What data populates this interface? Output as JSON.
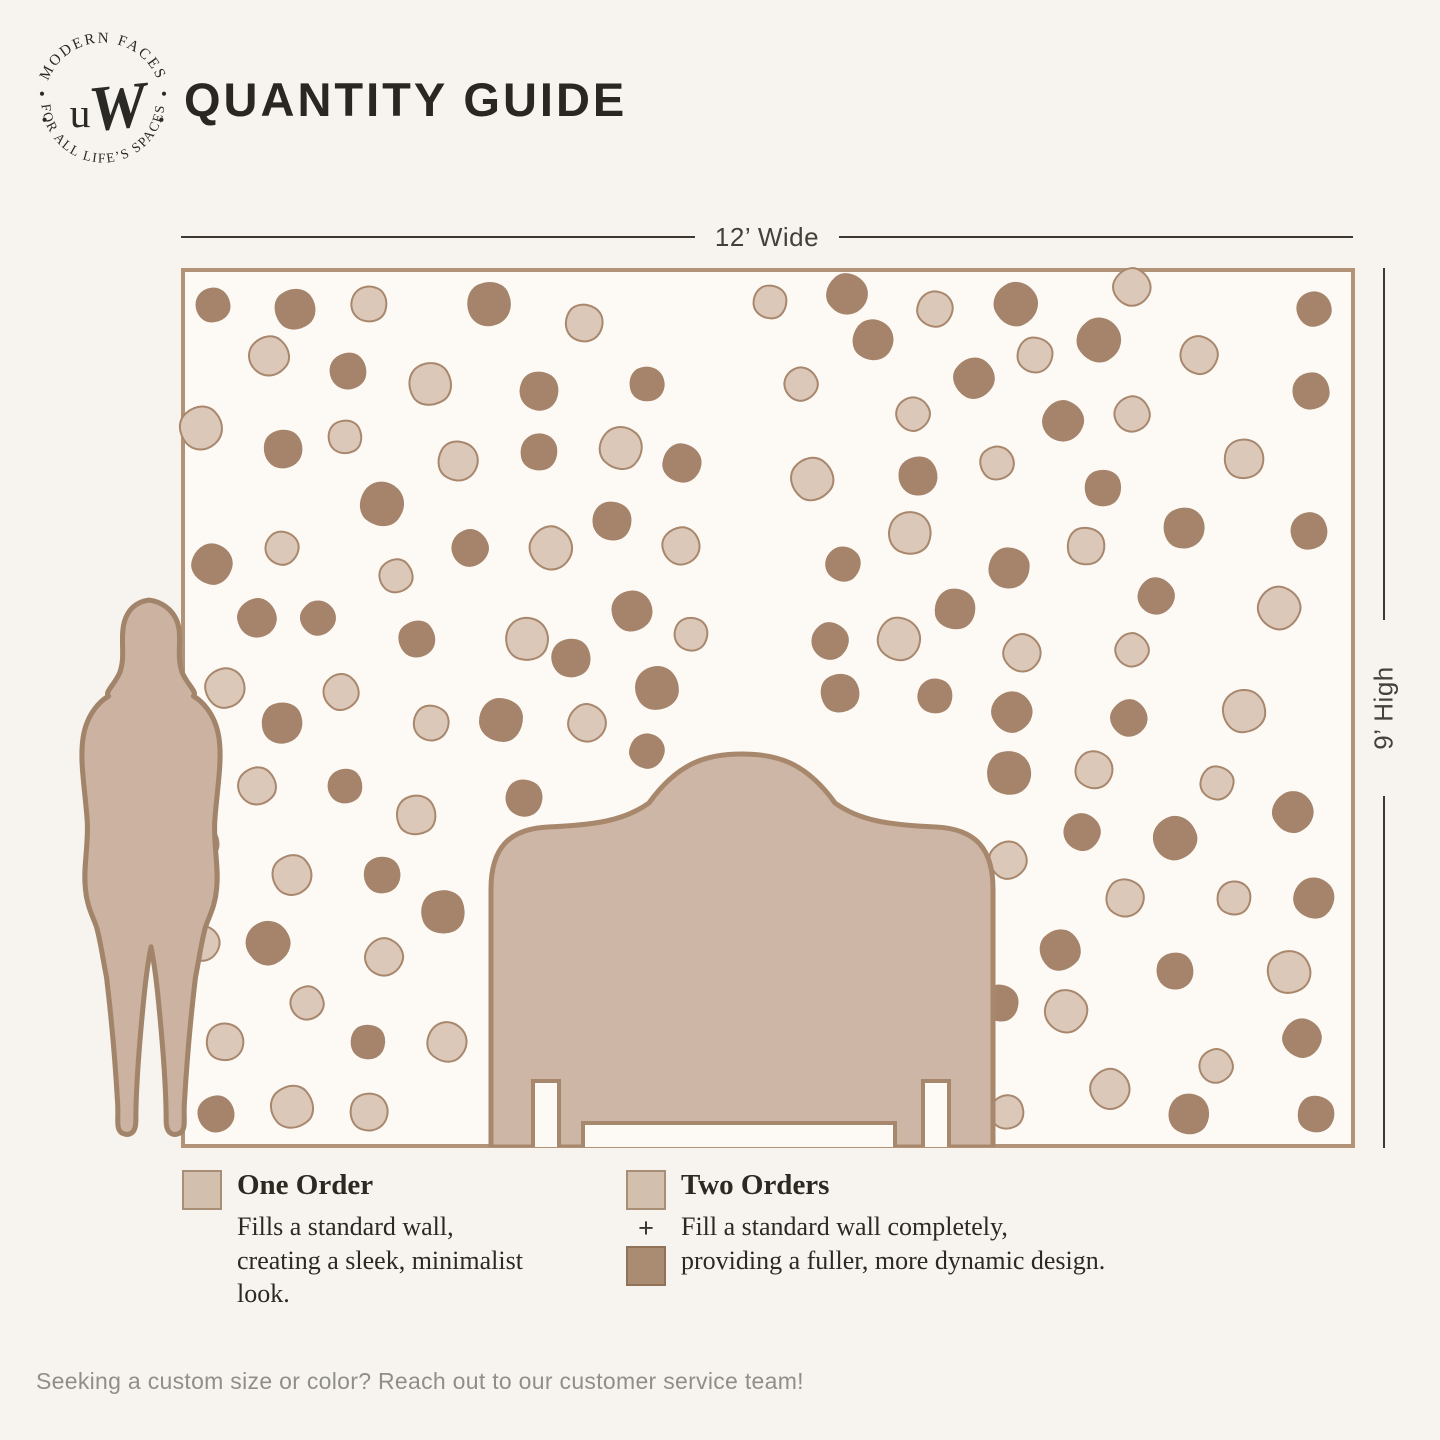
{
  "brand": {
    "logo_top_text": "MODERN FACES",
    "logo_bottom_text": "FOR ALL LIFE’S SPACES",
    "monogram_u": "u",
    "monogram_w": "W"
  },
  "header": {
    "title": "QUANTITY GUIDE"
  },
  "diagram": {
    "width_label": "12’ Wide",
    "height_label": "9’ High",
    "colors": {
      "page_background": "#f7f4ef",
      "wall_background": "#fdfaf5",
      "wall_border": "#b29377",
      "dot_dark": "#a5846b",
      "dot_light_fill": "#dcc8b9",
      "dot_light_outline": "#a8876d",
      "silhouette_fill": "#cbb2a1",
      "silhouette_outline": "#a1846a",
      "headboard_fill": "#cdb6a6",
      "headboard_outline": "#a8886d"
    },
    "dots": [
      {
        "x": 2.4,
        "y": 3.8,
        "c": "dark"
      },
      {
        "x": 9.4,
        "y": 4.2,
        "c": "dark"
      },
      {
        "x": 15.8,
        "y": 3.7,
        "c": "light"
      },
      {
        "x": 26.1,
        "y": 3.7,
        "c": "dark"
      },
      {
        "x": 34.2,
        "y": 5.9,
        "c": "light"
      },
      {
        "x": 50.2,
        "y": 3.4,
        "c": "light"
      },
      {
        "x": 56.8,
        "y": 2.5,
        "c": "dark"
      },
      {
        "x": 64.3,
        "y": 4.2,
        "c": "light"
      },
      {
        "x": 71.3,
        "y": 3.7,
        "c": "dark"
      },
      {
        "x": 81.2,
        "y": 1.7,
        "c": "light"
      },
      {
        "x": 96.8,
        "y": 4.2,
        "c": "dark"
      },
      {
        "x": 7.2,
        "y": 9.6,
        "c": "light"
      },
      {
        "x": 14.0,
        "y": 11.4,
        "c": "dark"
      },
      {
        "x": 21.0,
        "y": 12.9,
        "c": "light"
      },
      {
        "x": 30.4,
        "y": 13.7,
        "c": "dark"
      },
      {
        "x": 39.6,
        "y": 12.9,
        "c": "dark"
      },
      {
        "x": 59.0,
        "y": 7.8,
        "c": "dark"
      },
      {
        "x": 72.9,
        "y": 9.5,
        "c": "light"
      },
      {
        "x": 78.4,
        "y": 7.8,
        "c": "dark"
      },
      {
        "x": 87.0,
        "y": 9.5,
        "c": "light"
      },
      {
        "x": 52.8,
        "y": 12.8,
        "c": "light"
      },
      {
        "x": 67.7,
        "y": 12.2,
        "c": "dark"
      },
      {
        "x": 96.6,
        "y": 13.7,
        "c": "dark"
      },
      {
        "x": 1.4,
        "y": 17.9,
        "c": "light"
      },
      {
        "x": 8.4,
        "y": 20.3,
        "c": "dark"
      },
      {
        "x": 13.7,
        "y": 18.9,
        "c": "light"
      },
      {
        "x": 23.4,
        "y": 21.7,
        "c": "light"
      },
      {
        "x": 30.4,
        "y": 20.6,
        "c": "dark"
      },
      {
        "x": 37.4,
        "y": 20.2,
        "c": "light"
      },
      {
        "x": 42.6,
        "y": 21.9,
        "c": "dark"
      },
      {
        "x": 62.4,
        "y": 16.3,
        "c": "light"
      },
      {
        "x": 75.3,
        "y": 17.1,
        "c": "dark"
      },
      {
        "x": 81.2,
        "y": 16.3,
        "c": "light"
      },
      {
        "x": 53.8,
        "y": 23.7,
        "c": "light"
      },
      {
        "x": 62.9,
        "y": 23.4,
        "c": "dark"
      },
      {
        "x": 69.6,
        "y": 21.9,
        "c": "light"
      },
      {
        "x": 90.8,
        "y": 21.5,
        "c": "light"
      },
      {
        "x": 78.7,
        "y": 24.8,
        "c": "dark"
      },
      {
        "x": 16.9,
        "y": 26.6,
        "c": "dark"
      },
      {
        "x": 36.6,
        "y": 28.6,
        "c": "dark"
      },
      {
        "x": 8.3,
        "y": 31.7,
        "c": "light"
      },
      {
        "x": 2.3,
        "y": 33.5,
        "c": "dark"
      },
      {
        "x": 24.4,
        "y": 31.7,
        "c": "dark"
      },
      {
        "x": 31.4,
        "y": 31.7,
        "c": "light"
      },
      {
        "x": 42.5,
        "y": 31.4,
        "c": "light"
      },
      {
        "x": 18.1,
        "y": 34.9,
        "c": "light"
      },
      {
        "x": 85.7,
        "y": 29.4,
        "c": "dark"
      },
      {
        "x": 96.4,
        "y": 29.7,
        "c": "dark"
      },
      {
        "x": 62.2,
        "y": 29.9,
        "c": "light"
      },
      {
        "x": 77.3,
        "y": 31.4,
        "c": "light"
      },
      {
        "x": 56.4,
        "y": 33.5,
        "c": "dark"
      },
      {
        "x": 70.7,
        "y": 33.9,
        "c": "dark"
      },
      {
        "x": 83.3,
        "y": 37.1,
        "c": "dark"
      },
      {
        "x": 93.8,
        "y": 38.5,
        "c": "light"
      },
      {
        "x": 6.2,
        "y": 39.7,
        "c": "dark"
      },
      {
        "x": 11.4,
        "y": 39.7,
        "c": "dark"
      },
      {
        "x": 38.3,
        "y": 38.9,
        "c": "dark"
      },
      {
        "x": 19.9,
        "y": 42.1,
        "c": "dark"
      },
      {
        "x": 29.3,
        "y": 42.1,
        "c": "light"
      },
      {
        "x": 33.1,
        "y": 44.3,
        "c": "dark"
      },
      {
        "x": 43.4,
        "y": 41.5,
        "c": "light"
      },
      {
        "x": 66.0,
        "y": 38.6,
        "c": "dark"
      },
      {
        "x": 55.3,
        "y": 42.3,
        "c": "dark"
      },
      {
        "x": 61.2,
        "y": 42.1,
        "c": "light"
      },
      {
        "x": 71.8,
        "y": 43.7,
        "c": "light"
      },
      {
        "x": 81.2,
        "y": 43.4,
        "c": "light"
      },
      {
        "x": 3.4,
        "y": 47.7,
        "c": "light"
      },
      {
        "x": 13.4,
        "y": 48.2,
        "c": "light"
      },
      {
        "x": 40.5,
        "y": 47.7,
        "c": "dark"
      },
      {
        "x": 56.2,
        "y": 48.3,
        "c": "dark"
      },
      {
        "x": 64.3,
        "y": 48.6,
        "c": "dark"
      },
      {
        "x": 8.3,
        "y": 51.7,
        "c": "dark"
      },
      {
        "x": 21.1,
        "y": 51.7,
        "c": "light"
      },
      {
        "x": 27.1,
        "y": 51.4,
        "c": "dark"
      },
      {
        "x": 34.5,
        "y": 51.7,
        "c": "light"
      },
      {
        "x": 39.6,
        "y": 54.9,
        "c": "dark"
      },
      {
        "x": 70.9,
        "y": 50.5,
        "c": "dark"
      },
      {
        "x": 81.0,
        "y": 51.2,
        "c": "dark"
      },
      {
        "x": 90.8,
        "y": 50.3,
        "c": "light"
      },
      {
        "x": 6.2,
        "y": 58.9,
        "c": "light"
      },
      {
        "x": 13.7,
        "y": 58.9,
        "c": "dark"
      },
      {
        "x": 19.8,
        "y": 62.3,
        "c": "light"
      },
      {
        "x": 29.1,
        "y": 60.3,
        "c": "dark"
      },
      {
        "x": 70.7,
        "y": 57.5,
        "c": "dark"
      },
      {
        "x": 78.0,
        "y": 57.1,
        "c": "light"
      },
      {
        "x": 88.5,
        "y": 58.6,
        "c": "light"
      },
      {
        "x": 95.0,
        "y": 61.9,
        "c": "dark"
      },
      {
        "x": 76.9,
        "y": 64.2,
        "c": "dark"
      },
      {
        "x": 84.9,
        "y": 64.9,
        "c": "dark"
      },
      {
        "x": 70.6,
        "y": 67.4,
        "c": "light"
      },
      {
        "x": 1.5,
        "y": 65.5,
        "c": "light"
      },
      {
        "x": 9.2,
        "y": 69.1,
        "c": "light"
      },
      {
        "x": 16.9,
        "y": 69.1,
        "c": "dark"
      },
      {
        "x": 22.1,
        "y": 73.4,
        "c": "dark"
      },
      {
        "x": 80.6,
        "y": 71.8,
        "c": "light"
      },
      {
        "x": 90.0,
        "y": 71.8,
        "c": "light"
      },
      {
        "x": 96.8,
        "y": 71.8,
        "c": "dark"
      },
      {
        "x": 1.5,
        "y": 76.9,
        "c": "light"
      },
      {
        "x": 7.1,
        "y": 76.9,
        "c": "dark"
      },
      {
        "x": 17.1,
        "y": 78.6,
        "c": "light"
      },
      {
        "x": 10.5,
        "y": 83.8,
        "c": "light"
      },
      {
        "x": 75.0,
        "y": 77.7,
        "c": "dark"
      },
      {
        "x": 84.9,
        "y": 80.2,
        "c": "dark"
      },
      {
        "x": 94.7,
        "y": 80.3,
        "c": "light"
      },
      {
        "x": 3.4,
        "y": 88.3,
        "c": "light"
      },
      {
        "x": 15.7,
        "y": 88.3,
        "c": "dark"
      },
      {
        "x": 22.5,
        "y": 88.3,
        "c": "light"
      },
      {
        "x": 69.9,
        "y": 83.8,
        "c": "dark"
      },
      {
        "x": 75.6,
        "y": 84.8,
        "c": "light"
      },
      {
        "x": 95.8,
        "y": 87.8,
        "c": "dark"
      },
      {
        "x": 88.4,
        "y": 91.1,
        "c": "light"
      },
      {
        "x": 79.3,
        "y": 93.7,
        "c": "light"
      },
      {
        "x": 2.7,
        "y": 96.6,
        "c": "dark"
      },
      {
        "x": 9.2,
        "y": 95.8,
        "c": "light"
      },
      {
        "x": 15.8,
        "y": 96.3,
        "c": "light"
      },
      {
        "x": 70.5,
        "y": 96.3,
        "c": "light"
      },
      {
        "x": 86.1,
        "y": 96.6,
        "c": "dark"
      },
      {
        "x": 97.0,
        "y": 96.6,
        "c": "dark"
      }
    ]
  },
  "legend": {
    "items": [
      {
        "title": "One Order",
        "description": "Fills a standard wall, creating a sleek, minimalist look.",
        "plus": ""
      },
      {
        "title": "Two Orders",
        "description": "Fill a standard wall completely, providing a fuller, more dynamic design.",
        "plus": "+"
      }
    ]
  },
  "footer": {
    "note": "Seeking a custom size or color? Reach out to our customer service team!"
  }
}
